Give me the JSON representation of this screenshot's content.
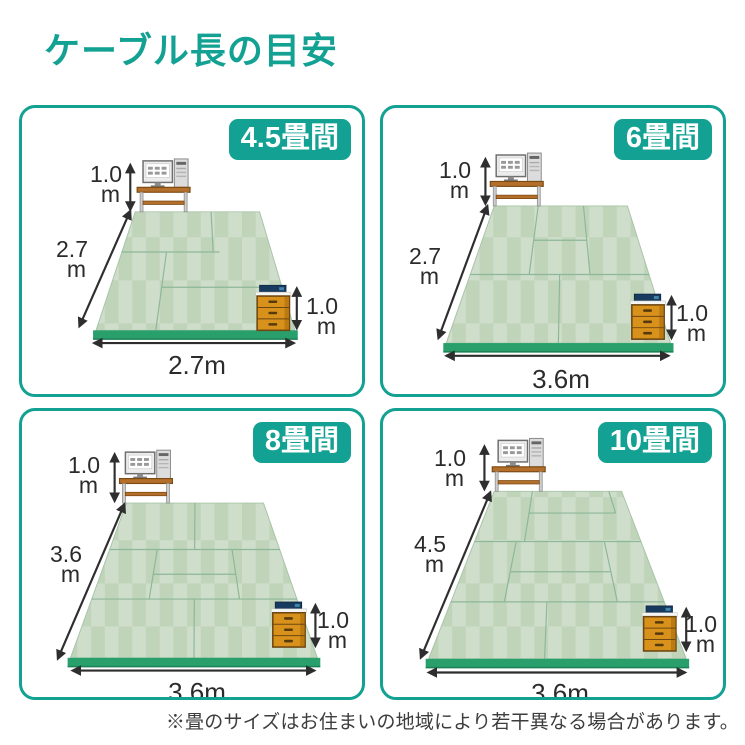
{
  "title": "ケーブル長の目安",
  "footnote": "※畳のサイズはお住まいの地域により若干異なる場合があります。",
  "colors": {
    "accent_teal": "#12a192",
    "tatami_light": "#cfdeca",
    "tatami_dark": "#c0d4ba",
    "floor_base_green": "#29a06c",
    "chest_orange": "#d8921c",
    "desk_brown": "#b4702a"
  },
  "panels": [
    {
      "badge": "4.5畳間",
      "desk_height_value": "1.0",
      "desk_height_unit": "m",
      "room_depth_value": "2.7",
      "room_depth_unit": "m",
      "room_width_label": "2.7m",
      "chest_height_value": "1.0",
      "chest_height_unit": "m"
    },
    {
      "badge": "6畳間",
      "desk_height_value": "1.0",
      "desk_height_unit": "m",
      "room_depth_value": "2.7",
      "room_depth_unit": "m",
      "room_width_label": "3.6m",
      "chest_height_value": "1.0",
      "chest_height_unit": "m"
    },
    {
      "badge": "8畳間",
      "desk_height_value": "1.0",
      "desk_height_unit": "m",
      "room_depth_value": "3.6",
      "room_depth_unit": "m",
      "room_width_label": "3.6m",
      "chest_height_value": "1.0",
      "chest_height_unit": "m"
    },
    {
      "badge": "10畳間",
      "desk_height_value": "1.0",
      "desk_height_unit": "m",
      "room_depth_value": "4.5",
      "room_depth_unit": "m",
      "room_width_label": "3.6m",
      "chest_height_value": "1.0",
      "chest_height_unit": "m"
    }
  ]
}
